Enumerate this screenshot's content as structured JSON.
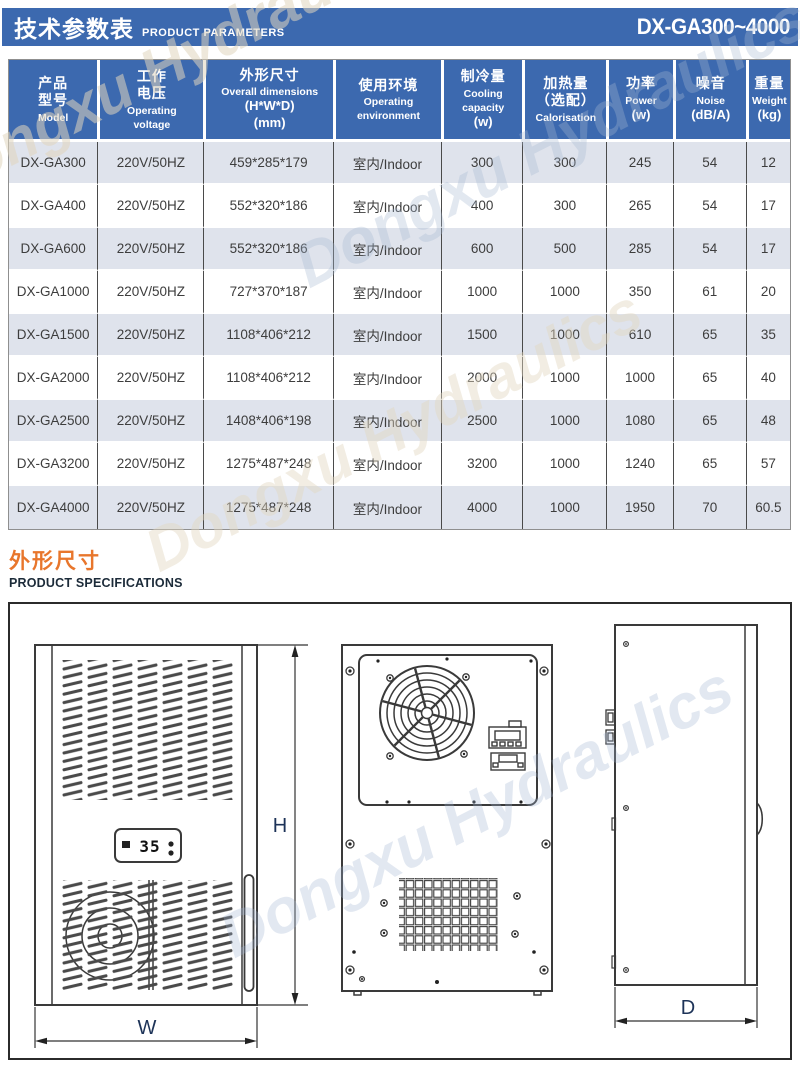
{
  "header": {
    "title_zh": "技术参数表",
    "title_en": "PRODUCT PARAMETERS",
    "model_range": "DX-GA300~4000"
  },
  "watermark": "Dongxu Hydraulics",
  "colors": {
    "header_bar": "#3c69af",
    "table_header": "#3c69af",
    "row_stripe": "#dfe3ec",
    "accent_orange": "#e8762c"
  },
  "table": {
    "columns": [
      {
        "zh": [
          "产品",
          "型号"
        ],
        "en": [
          "Model"
        ],
        "big": []
      },
      {
        "zh": [
          "工作",
          "电压"
        ],
        "en": [
          "Operating",
          "voltage"
        ],
        "big": []
      },
      {
        "zh": [
          "外形尺寸"
        ],
        "en": [
          "Overall dimensions"
        ],
        "big": [
          "(H*W*D)",
          "(mm)"
        ]
      },
      {
        "zh": [
          "使用环境"
        ],
        "en": [
          "Operating",
          "environment"
        ],
        "big": []
      },
      {
        "zh": [
          "制冷量"
        ],
        "en": [
          "Cooling",
          "capacity"
        ],
        "big": [
          "(w)"
        ]
      },
      {
        "zh": [
          "加热量",
          "（选配）"
        ],
        "en": [
          "Calorisation"
        ],
        "big": []
      },
      {
        "zh": [
          "功率"
        ],
        "en": [
          "Power"
        ],
        "big": [
          "(w)"
        ]
      },
      {
        "zh": [
          "噪音"
        ],
        "en": [
          "Noise"
        ],
        "big": [
          "(dB/A)"
        ]
      },
      {
        "zh": [
          "重量"
        ],
        "en": [
          "Weight"
        ],
        "big": [
          "(kg)"
        ]
      }
    ],
    "rows": [
      [
        "DX-GA300",
        "220V/50HZ",
        "459*285*179",
        "室内/Indoor",
        "300",
        "300",
        "245",
        "54",
        "12"
      ],
      [
        "DX-GA400",
        "220V/50HZ",
        "552*320*186",
        "室内/Indoor",
        "400",
        "300",
        "265",
        "54",
        "17"
      ],
      [
        "DX-GA600",
        "220V/50HZ",
        "552*320*186",
        "室内/Indoor",
        "600",
        "500",
        "285",
        "54",
        "17"
      ],
      [
        "DX-GA1000",
        "220V/50HZ",
        "727*370*187",
        "室内/Indoor",
        "1000",
        "1000",
        "350",
        "61",
        "20"
      ],
      [
        "DX-GA1500",
        "220V/50HZ",
        "1108*406*212",
        "室内/Indoor",
        "1500",
        "1000",
        "610",
        "65",
        "35"
      ],
      [
        "DX-GA2000",
        "220V/50HZ",
        "1108*406*212",
        "室内/Indoor",
        "2000",
        "1000",
        "1000",
        "65",
        "40"
      ],
      [
        "DX-GA2500",
        "220V/50HZ",
        "1408*406*198",
        "室内/Indoor",
        "2500",
        "1000",
        "1080",
        "65",
        "48"
      ],
      [
        "DX-GA3200",
        "220V/50HZ",
        "1275*487*248",
        "室内/Indoor",
        "3200",
        "1000",
        "1240",
        "65",
        "57"
      ],
      [
        "DX-GA4000",
        "220V/50HZ",
        "1275*487*248",
        "室内/Indoor",
        "4000",
        "1000",
        "1950",
        "70",
        "60.5"
      ]
    ]
  },
  "section": {
    "title_zh": "外形尺寸",
    "title_en": "PRODUCT SPECIFICATIONS"
  },
  "drawing": {
    "display_value": "35",
    "labels": {
      "height": "H",
      "width": "W",
      "depth": "D"
    }
  }
}
